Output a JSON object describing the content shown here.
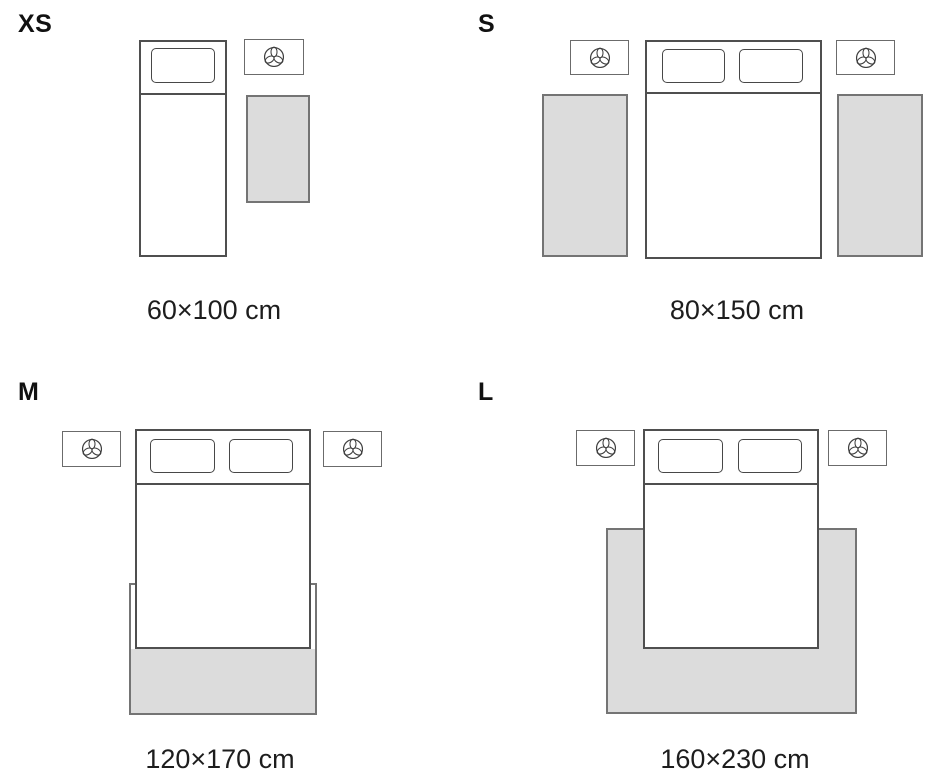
{
  "colors": {
    "bg": "#ffffff",
    "text": "#1d1d1d",
    "label": "#111111",
    "bed-border": "#4f4f4f",
    "pillow-border": "#474747",
    "stand-border": "#6b6b6b",
    "plant-stroke": "#3d3d3d",
    "rug-border": "#747474",
    "rug-fill": "#dcdcdc"
  },
  "icons": {
    "plant-icon": "potted plant top view, three-leaf trefoil inside circle (SVG outline)"
  },
  "sizes": [
    {
      "label": "XS",
      "caption": "60×100 cm",
      "bed": "single",
      "nightstands": 1,
      "rugs": 1
    },
    {
      "label": "S",
      "caption": "80×150 cm",
      "bed": "double",
      "nightstands": 2,
      "rugs": 2
    },
    {
      "label": "M",
      "caption": "120×170 cm",
      "bed": "double",
      "nightstands": 2,
      "rugs": 1
    },
    {
      "label": "L",
      "caption": "160×230 cm",
      "bed": "double",
      "nightstands": 2,
      "rugs": 1
    }
  ]
}
